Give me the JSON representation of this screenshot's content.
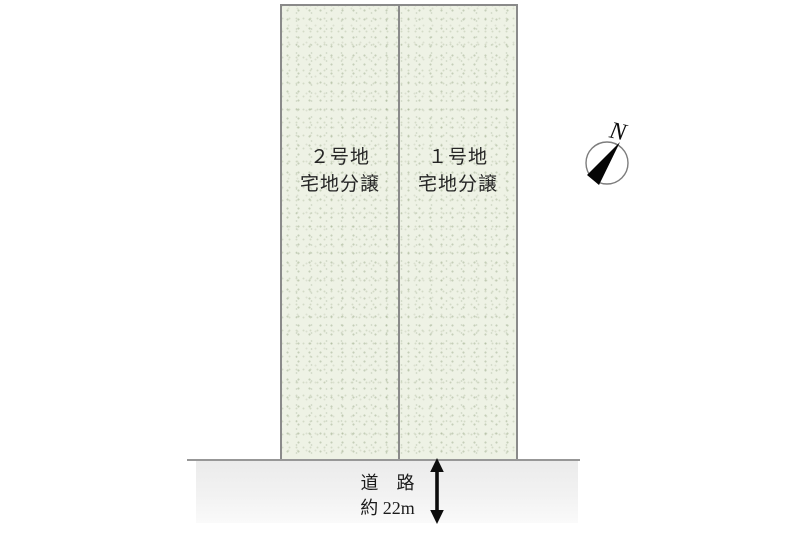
{
  "diagram_title": "residential-lot-layout",
  "plots": [
    {
      "name": "２号地",
      "type": "宅地分譲"
    },
    {
      "name": "１号地",
      "type": "宅地分譲"
    }
  ],
  "road": {
    "name": "道　路",
    "width": "約 22m"
  },
  "compass": {
    "north_label": "N"
  },
  "colors": {
    "background": "#ffffff",
    "plot_fill": "#eef2e5",
    "plot_border": "#8a8a8a",
    "road_line": "#979797",
    "road_fill_top": "#ebebeb",
    "road_fill_bottom": "#fafafa",
    "text": "#1f1f1f",
    "arrow": "#0d0d0d"
  }
}
